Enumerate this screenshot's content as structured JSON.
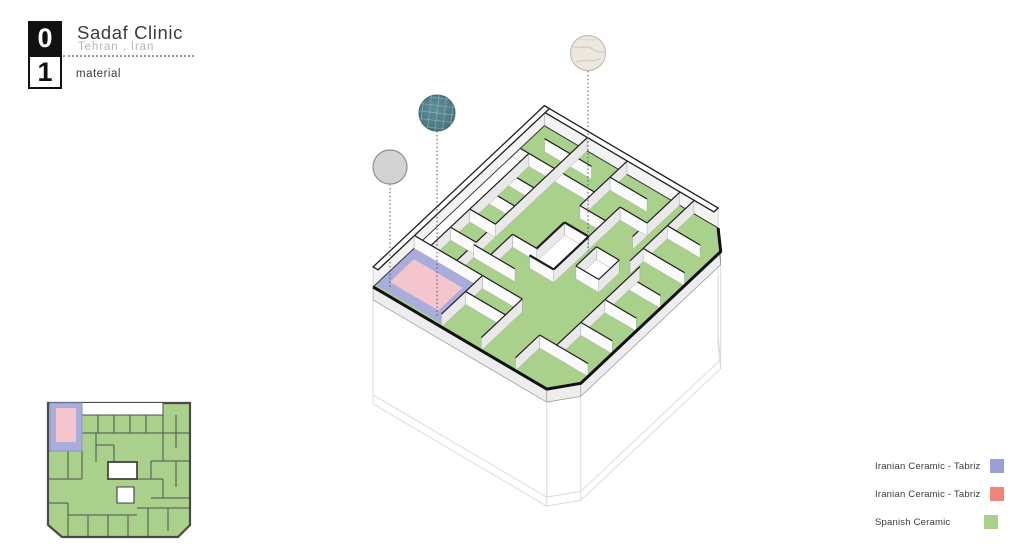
{
  "header": {
    "badge_digits": [
      "0",
      "1"
    ],
    "title": "Sadaf Clinic",
    "subtitle": "Tehran , Iran",
    "sheet_label": "material"
  },
  "legend": {
    "items": [
      {
        "label": "Iranian Ceramic - Tabriz",
        "color": "#9aa0d4"
      },
      {
        "label": "Iranian Ceramic - Tabriz",
        "color": "#f2847c"
      },
      {
        "label": "Spanish Ceramic",
        "color": "#a9d18c"
      }
    ]
  },
  "material_samples": [
    {
      "name": "plain-gray-sample",
      "color": "#d3d3d3"
    },
    {
      "name": "teal-tile-sample",
      "color": "#4e7b86"
    },
    {
      "name": "marble-sample",
      "color": "#ece8e0"
    }
  ],
  "colors": {
    "floor_green": "#a9d18c",
    "room_pink": "#f5c5cd",
    "room_purple": "#a8addc",
    "wall_line": "#1c1c1c",
    "wall_face_light": "#fafafa",
    "wall_face_shade": "#e9e9e9",
    "slab_face": "#ededed",
    "ghost_line": "#d8d8d8",
    "plan_outline": "#4a4a4a"
  }
}
